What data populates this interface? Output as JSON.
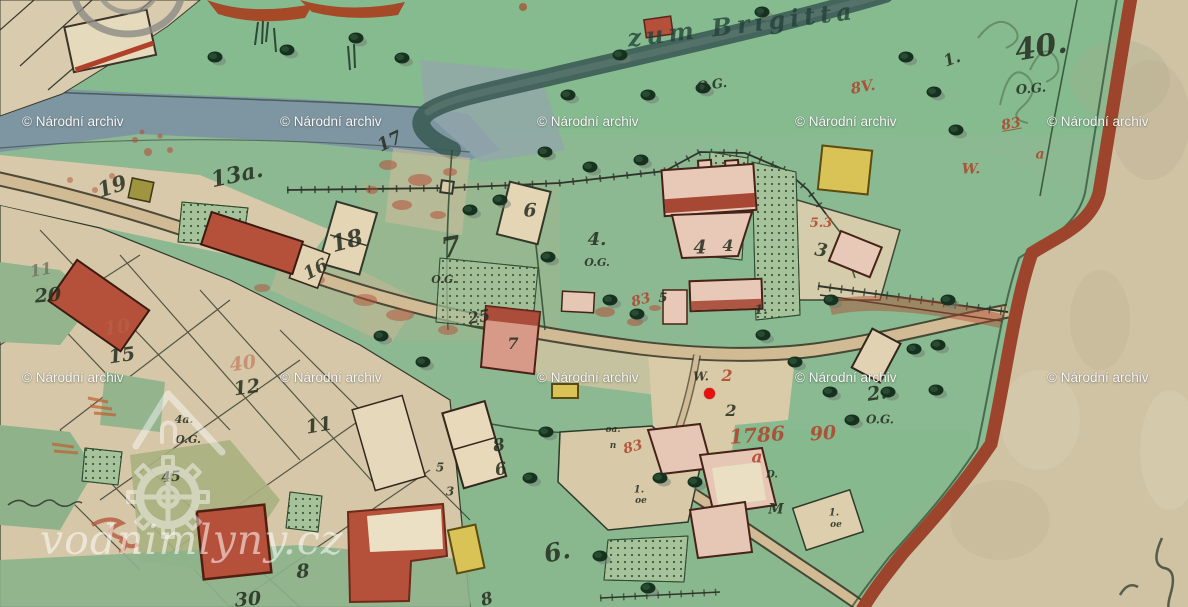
{
  "watermarks": {
    "archive_text": "© Národní archiv",
    "archive_positions": [
      [
        22,
        115
      ],
      [
        280,
        115
      ],
      [
        537,
        115
      ],
      [
        795,
        115
      ],
      [
        1047,
        115
      ],
      [
        22,
        371
      ],
      [
        280,
        371
      ],
      [
        537,
        371
      ],
      [
        795,
        371
      ],
      [
        1047,
        371
      ]
    ],
    "site_text": "vodnimlyny.cz"
  },
  "marker": {
    "x": 709,
    "y": 393,
    "diameter": 11,
    "color": "#e81111"
  },
  "map": {
    "labels": [
      {
        "t": "zum Brigitta",
        "x": 742,
        "y": 26,
        "s": 24,
        "r": -7,
        "c": "cursive"
      },
      {
        "t": "O.G.",
        "x": 712,
        "y": 86,
        "s": 13,
        "r": -8,
        "c": "ink"
      },
      {
        "t": "40.",
        "x": 1041,
        "y": 49,
        "s": 30,
        "r": -10,
        "c": "ink"
      },
      {
        "t": "O.G.",
        "x": 1031,
        "y": 90,
        "s": 13,
        "r": -5,
        "c": "ink"
      },
      {
        "t": "19",
        "x": 112,
        "y": 187,
        "s": 21,
        "r": -18,
        "c": "ink"
      },
      {
        "t": "13a.",
        "x": 237,
        "y": 176,
        "s": 22,
        "r": -12,
        "c": "ink"
      },
      {
        "t": "17",
        "x": 390,
        "y": 143,
        "s": 18,
        "r": -25,
        "c": "ink"
      },
      {
        "t": "18",
        "x": 347,
        "y": 242,
        "s": 23,
        "r": -15,
        "c": "ink"
      },
      {
        "t": "16",
        "x": 316,
        "y": 271,
        "s": 18,
        "r": -28,
        "c": "ink"
      },
      {
        "t": "6",
        "x": 530,
        "y": 212,
        "s": 19,
        "r": 0,
        "c": "ink"
      },
      {
        "t": "4.",
        "x": 597,
        "y": 241,
        "s": 18,
        "r": 0,
        "c": "ink"
      },
      {
        "t": "O.G.",
        "x": 597,
        "y": 263,
        "s": 11,
        "r": 0,
        "c": "ink"
      },
      {
        "t": "7",
        "x": 451,
        "y": 249,
        "s": 28,
        "r": -10,
        "c": "ink"
      },
      {
        "t": "O.G.",
        "x": 444,
        "y": 280,
        "s": 11,
        "r": 0,
        "c": "ink"
      },
      {
        "t": "4",
        "x": 700,
        "y": 249,
        "s": 19,
        "r": 0,
        "c": "ink"
      },
      {
        "t": "4",
        "x": 728,
        "y": 247,
        "s": 16,
        "r": 0,
        "c": "ink"
      },
      {
        "t": "3",
        "x": 821,
        "y": 252,
        "s": 18,
        "r": 10,
        "c": "ink"
      },
      {
        "t": "5",
        "x": 663,
        "y": 299,
        "s": 13,
        "r": 0,
        "c": "ink"
      },
      {
        "t": "1.",
        "x": 761,
        "y": 311,
        "s": 13,
        "r": 0,
        "c": "ink"
      },
      {
        "t": "20",
        "x": 48,
        "y": 297,
        "s": 19,
        "r": -5,
        "c": "ink"
      },
      {
        "t": "11",
        "x": 41,
        "y": 271,
        "s": 16,
        "r": -10,
        "c": "pencil"
      },
      {
        "t": "15",
        "x": 122,
        "y": 357,
        "s": 19,
        "r": -8,
        "c": "ink"
      },
      {
        "t": "12",
        "x": 247,
        "y": 389,
        "s": 19,
        "r": -8,
        "c": "ink"
      },
      {
        "t": "11",
        "x": 319,
        "y": 427,
        "s": 19,
        "r": -10,
        "c": "ink"
      },
      {
        "t": "25",
        "x": 479,
        "y": 318,
        "s": 16,
        "r": -10,
        "c": "ink"
      },
      {
        "t": "7",
        "x": 513,
        "y": 345,
        "s": 16,
        "r": 0,
        "c": "ink"
      },
      {
        "t": "W.",
        "x": 701,
        "y": 377,
        "s": 12,
        "r": 0,
        "c": "ink"
      },
      {
        "t": "8",
        "x": 499,
        "y": 447,
        "s": 17,
        "r": -10,
        "c": "ink"
      },
      {
        "t": "6",
        "x": 501,
        "y": 471,
        "s": 17,
        "r": -10,
        "c": "ink"
      },
      {
        "t": "5",
        "x": 440,
        "y": 468,
        "s": 12,
        "r": 0,
        "c": "ink"
      },
      {
        "t": "3",
        "x": 450,
        "y": 492,
        "s": 12,
        "r": 0,
        "c": "ink"
      },
      {
        "t": "8",
        "x": 303,
        "y": 573,
        "s": 19,
        "r": -5,
        "c": "ink"
      },
      {
        "t": "30",
        "x": 248,
        "y": 601,
        "s": 19,
        "r": -5,
        "c": "ink"
      },
      {
        "t": "6.",
        "x": 557,
        "y": 553,
        "s": 25,
        "r": -12,
        "c": "ink"
      },
      {
        "t": "8",
        "x": 487,
        "y": 601,
        "s": 17,
        "r": -15,
        "c": "ink"
      },
      {
        "t": "2",
        "x": 731,
        "y": 412,
        "s": 16,
        "r": 0,
        "c": "ink"
      },
      {
        "t": "M",
        "x": 776,
        "y": 510,
        "s": 14,
        "r": 0,
        "c": "ink"
      },
      {
        "t": "1.",
        "x": 639,
        "y": 491,
        "s": 10,
        "r": 0,
        "c": "ink"
      },
      {
        "t": "oe",
        "x": 641,
        "y": 502,
        "s": 9,
        "r": 0,
        "c": "ink"
      },
      {
        "t": "1.",
        "x": 834,
        "y": 514,
        "s": 10,
        "r": 0,
        "c": "ink"
      },
      {
        "t": "oe",
        "x": 836,
        "y": 526,
        "s": 9,
        "r": 0,
        "c": "ink"
      },
      {
        "t": "oa.",
        "x": 613,
        "y": 431,
        "s": 9,
        "r": 0,
        "c": "ink"
      },
      {
        "t": "n",
        "x": 613,
        "y": 447,
        "s": 9,
        "r": 0,
        "c": "ink"
      },
      {
        "t": "2.",
        "x": 877,
        "y": 395,
        "s": 19,
        "r": -8,
        "c": "ink"
      },
      {
        "t": "O.G.",
        "x": 880,
        "y": 420,
        "s": 12,
        "r": 0,
        "c": "ink"
      },
      {
        "t": "45",
        "x": 171,
        "y": 478,
        "s": 14,
        "r": -5,
        "c": "ink"
      },
      {
        "t": "4a.",
        "x": 184,
        "y": 420,
        "s": 11,
        "r": 0,
        "c": "ink"
      },
      {
        "t": "O.G.",
        "x": 188,
        "y": 440,
        "s": 11,
        "r": 0,
        "c": "ink"
      },
      {
        "t": "D.",
        "x": 772,
        "y": 476,
        "s": 10,
        "r": 0,
        "c": "ink"
      },
      {
        "t": "1.",
        "x": 952,
        "y": 60,
        "s": 16,
        "r": -20,
        "c": "ink"
      },
      {
        "t": "2",
        "x": 727,
        "y": 377,
        "s": 16,
        "r": 0,
        "c": "red"
      },
      {
        "t": "1786",
        "x": 757,
        "y": 436,
        "s": 20,
        "r": -4,
        "c": "red"
      },
      {
        "t": "90",
        "x": 823,
        "y": 435,
        "s": 19,
        "r": -4,
        "c": "red"
      },
      {
        "t": "a",
        "x": 757,
        "y": 459,
        "s": 17,
        "r": 0,
        "c": "red"
      },
      {
        "t": "83",
        "x": 641,
        "y": 301,
        "s": 14,
        "r": -15,
        "c": "red"
      },
      {
        "t": "83",
        "x": 633,
        "y": 448,
        "s": 14,
        "r": -15,
        "c": "red"
      },
      {
        "t": "40",
        "x": 243,
        "y": 365,
        "s": 19,
        "r": -8,
        "c": "red-faded"
      },
      {
        "t": "10",
        "x": 117,
        "y": 329,
        "s": 19,
        "r": -8,
        "c": "red-faded"
      },
      {
        "t": "W.",
        "x": 971,
        "y": 170,
        "s": 14,
        "r": 0,
        "c": "red"
      },
      {
        "t": "83",
        "x": 1011,
        "y": 125,
        "s": 14,
        "r": -10,
        "c": "red frac"
      },
      {
        "t": "a",
        "x": 1040,
        "y": 155,
        "s": 14,
        "r": 0,
        "c": "red"
      },
      {
        "t": "8V.",
        "x": 863,
        "y": 88,
        "s": 15,
        "r": -10,
        "c": "red"
      },
      {
        "t": "5.3",
        "x": 821,
        "y": 224,
        "s": 13,
        "r": 0,
        "c": "red"
      }
    ],
    "trees": [
      [
        215,
        57
      ],
      [
        287,
        50
      ],
      [
        356,
        38
      ],
      [
        402,
        58
      ],
      [
        648,
        95
      ],
      [
        703,
        88
      ],
      [
        762,
        12
      ],
      [
        545,
        152
      ],
      [
        590,
        167
      ],
      [
        641,
        160
      ],
      [
        470,
        210
      ],
      [
        500,
        200
      ],
      [
        548,
        257
      ],
      [
        610,
        300
      ],
      [
        637,
        314
      ],
      [
        906,
        57
      ],
      [
        934,
        92
      ],
      [
        956,
        130
      ],
      [
        938,
        345
      ],
      [
        914,
        349
      ],
      [
        888,
        392
      ],
      [
        936,
        390
      ],
      [
        830,
        392
      ],
      [
        852,
        420
      ],
      [
        948,
        300
      ],
      [
        831,
        300
      ],
      [
        423,
        362
      ],
      [
        381,
        336
      ],
      [
        530,
        478
      ],
      [
        546,
        432
      ],
      [
        600,
        556
      ],
      [
        648,
        588
      ],
      [
        660,
        478
      ],
      [
        695,
        482
      ],
      [
        763,
        335
      ],
      [
        795,
        362
      ],
      [
        568,
        95
      ],
      [
        620,
        55
      ]
    ]
  },
  "colors": {
    "parchment": "#cfc3a4",
    "field_green": "#8cb892",
    "river_gray_blue": "#7e96a2",
    "stream_dark": "#3c5c55",
    "building_pink": "#e7c6b5",
    "building_red": "#b5503a",
    "building_yellow": "#d9c356",
    "border_stripe": "#9c442c",
    "ink": "#252d1f",
    "red_ink": "#b0432a",
    "watermark_white": "#ffffff",
    "marker_red": "#e81111"
  }
}
